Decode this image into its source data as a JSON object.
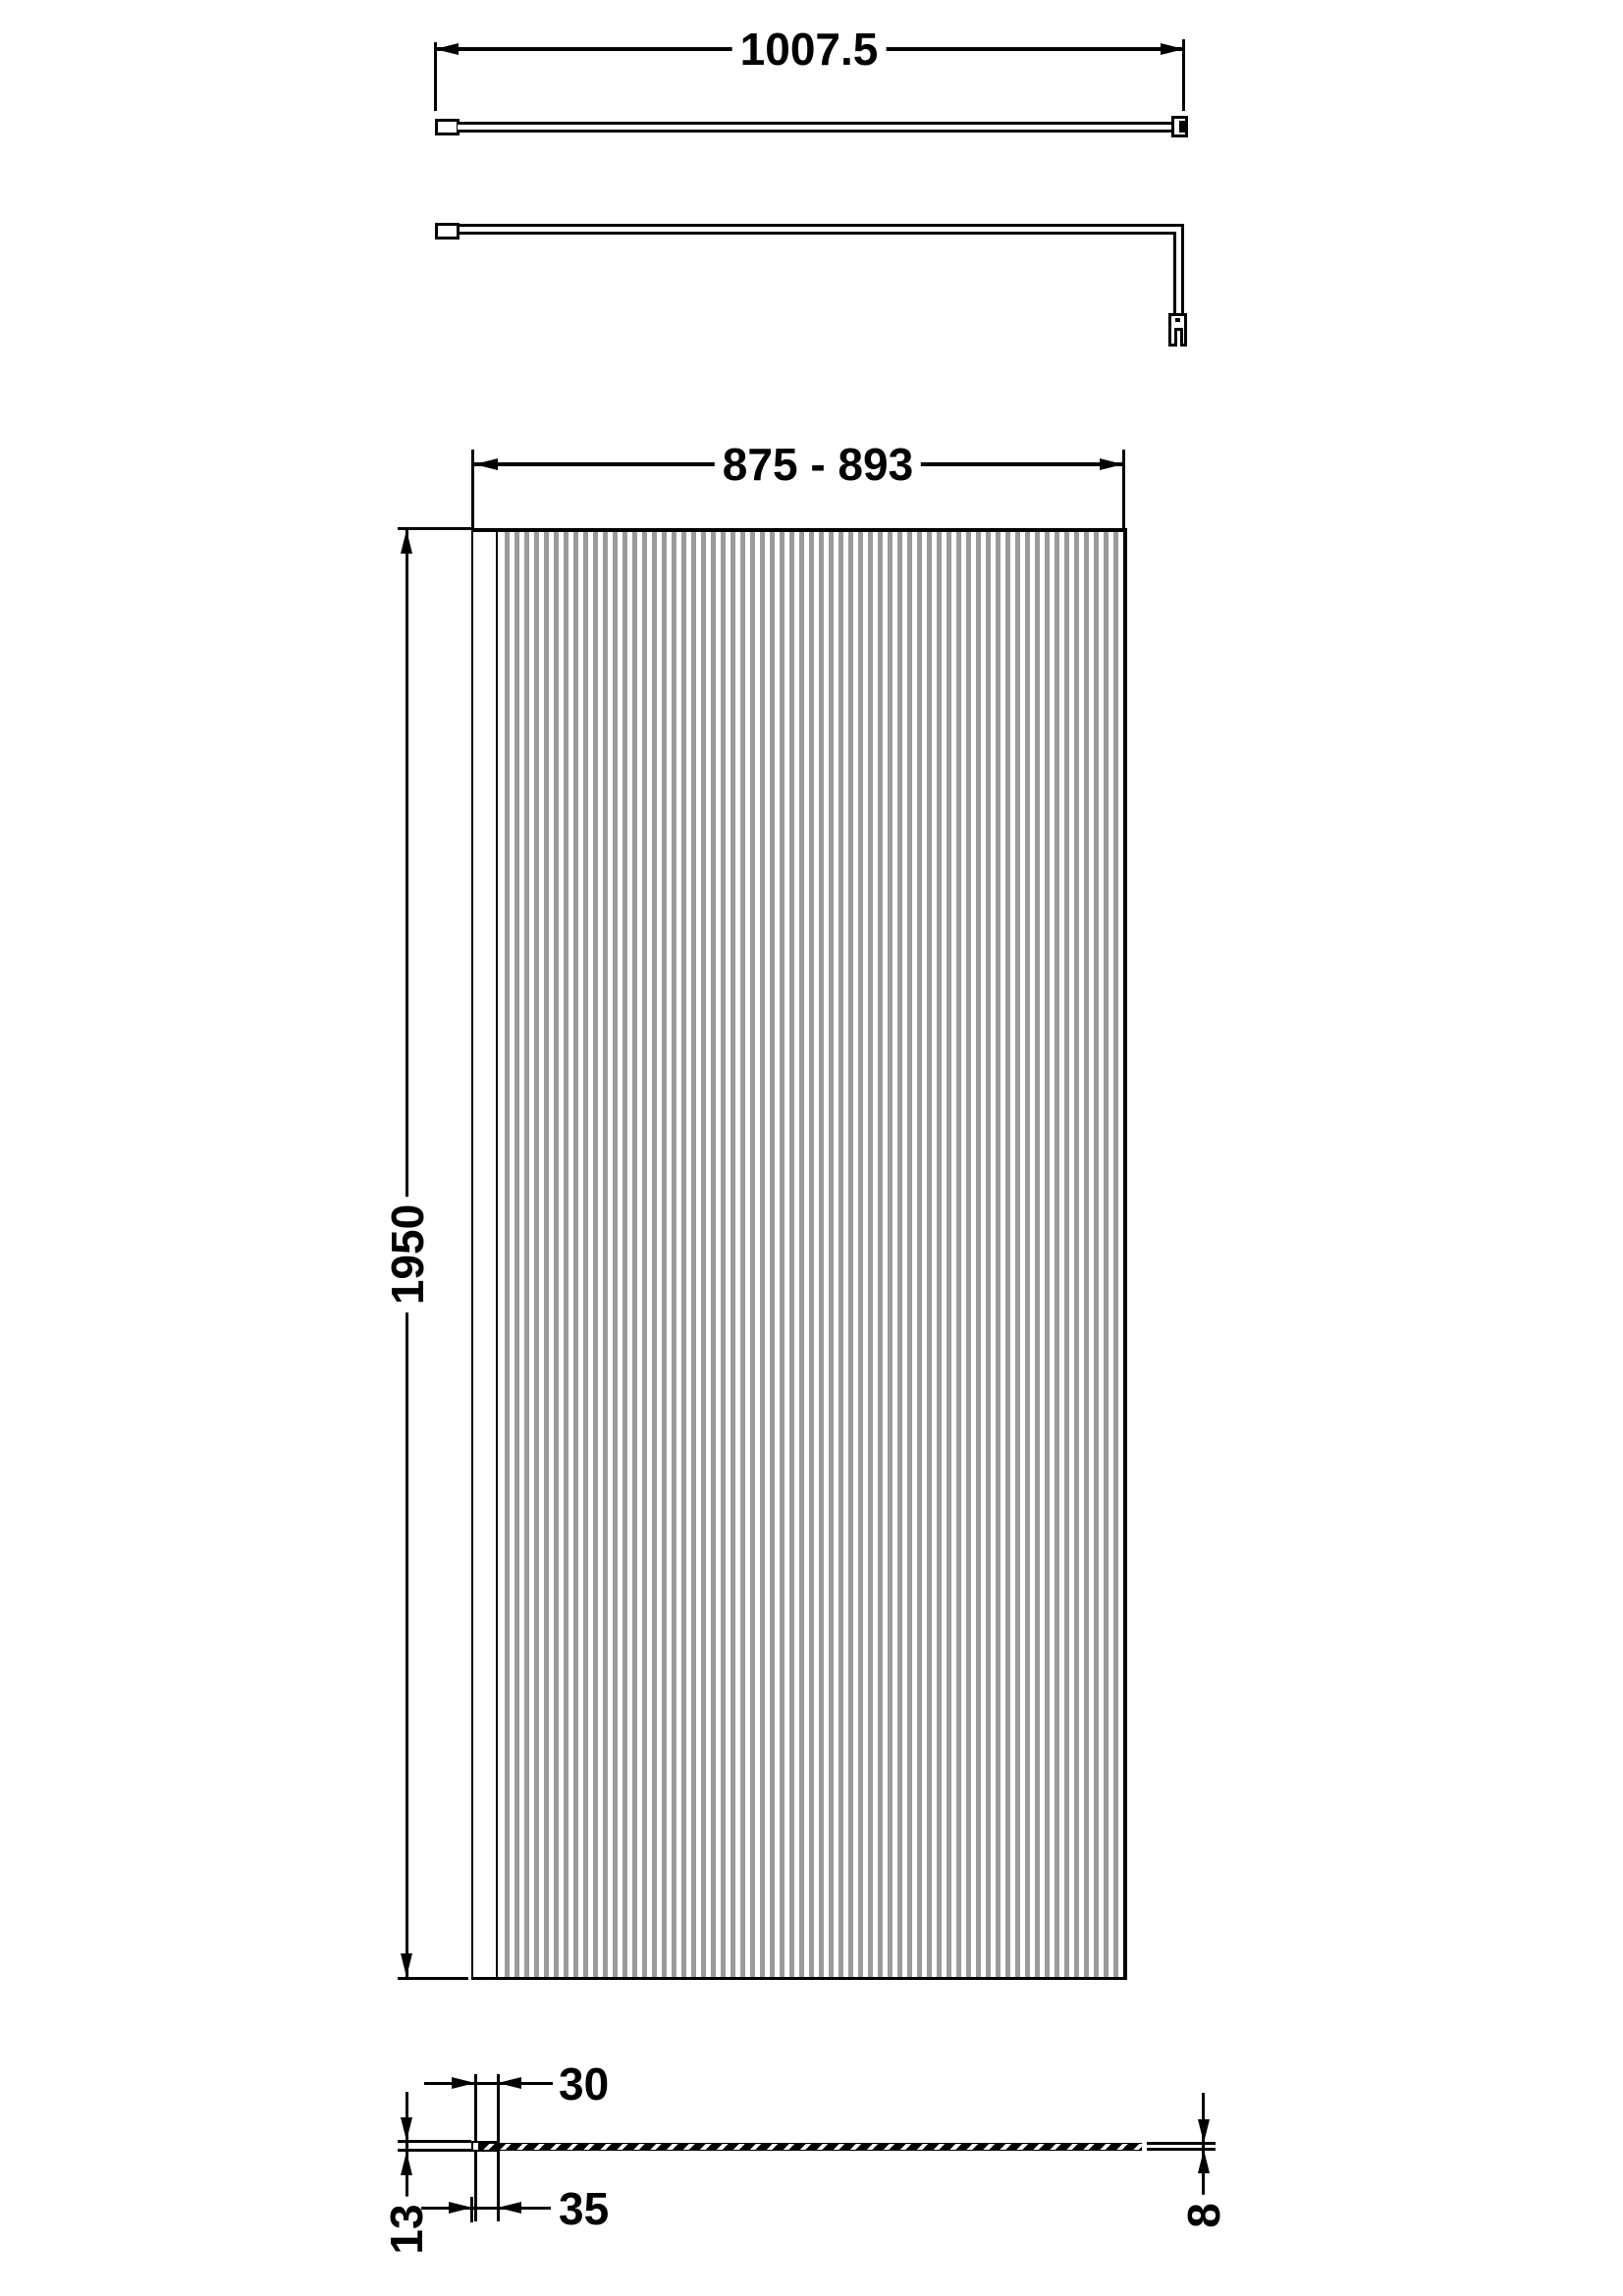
{
  "drawing": {
    "subject": "fluted-glass-wetroom-screen-technical-drawing",
    "background": "#ffffff",
    "line_color": "#000000",
    "flute_color": "#9b9b9b",
    "flute_count": 64,
    "views": {
      "plan": "support-arm-plan-view",
      "side": "support-arm-side-view",
      "front": "screen-front-view",
      "section": "wall-profile-cross-section"
    },
    "labels": {
      "arm_length": "1007.5",
      "screen_width_range": "875 - 893",
      "screen_height": "1950",
      "profile_inner_width": "30",
      "profile_outer_width": "35",
      "profile_depth": "13",
      "glass_thickness": "8"
    }
  }
}
